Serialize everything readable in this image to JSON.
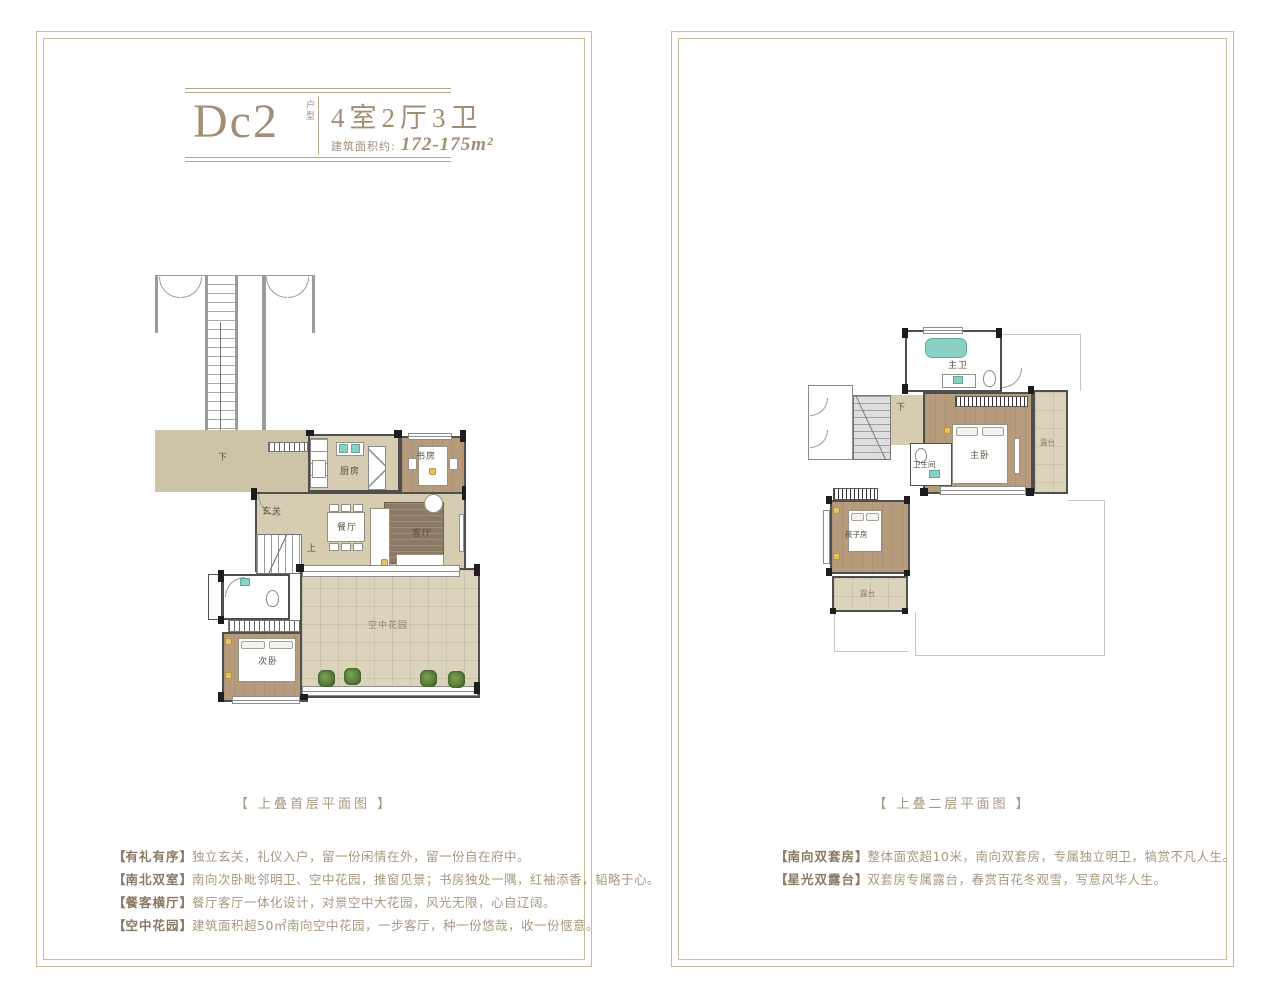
{
  "punct": {
    "open": "【",
    "close": "】"
  },
  "left_panel": {
    "title": {
      "code": "Dc2",
      "code_tag": "户型",
      "rooms": "4室2厅3卫",
      "area_label": "建筑面积约:",
      "area_value": "172-175m²"
    },
    "caption": "【 上叠首层平面图 】",
    "features": [
      {
        "tag": "有礼有序",
        "text": "独立玄关，礼仪入户，留一份闲情在外，留一份自在府中。"
      },
      {
        "tag": "南北双室",
        "text": "南向次卧毗邻明卫、空中花园，推窗见景；书房独处一隅，红袖添香，韬略于心。"
      },
      {
        "tag": "餐客横厅",
        "text": "餐厅客厅一体化设计，对景空中大花园，风光无限，心自辽阔。"
      },
      {
        "tag": "空中花园",
        "text": "建筑面积超50㎡南向空中花园，一步客厅，种一份悠哉，收一份惬意。"
      }
    ],
    "plan": {
      "labels": {
        "hall_down": "下",
        "kitchen": "厨房",
        "study": "书房",
        "foyer": "玄关",
        "dining": "餐厅",
        "living": "客厅",
        "stairs_up": "上",
        "bedroom2": "次卧",
        "sky_garden": "空中花园"
      }
    }
  },
  "right_panel": {
    "caption": "【 上叠二层平面图 】",
    "features": [
      {
        "tag": "南向双套房",
        "text": "整体面宽超10米，南向双套房，专属独立明卫，犒赏不凡人生。"
      },
      {
        "tag": "星光双露台",
        "text": "双套房专属露台，春赏百花冬观雪，写意风华人生。"
      }
    ],
    "plan": {
      "labels": {
        "master_bath": "主卫",
        "stairs_down": "下",
        "master_bedroom": "主卧",
        "terrace_east": "露台",
        "bathroom": "卫生间",
        "kids_room": "孩子房",
        "terrace_south": "露台"
      }
    }
  },
  "colors": {
    "frame": "#c9bd9b",
    "title_brown": "#a28e74",
    "feature_tag": "#8b7862",
    "feature_text": "#a7987f",
    "floor_tan": "#d6ccb1",
    "floor_wood": "#b69b7d",
    "garden": "#dcd4ba",
    "fixture_teal": "#8ad0c4",
    "wall_dark": "#4f4f4f"
  }
}
